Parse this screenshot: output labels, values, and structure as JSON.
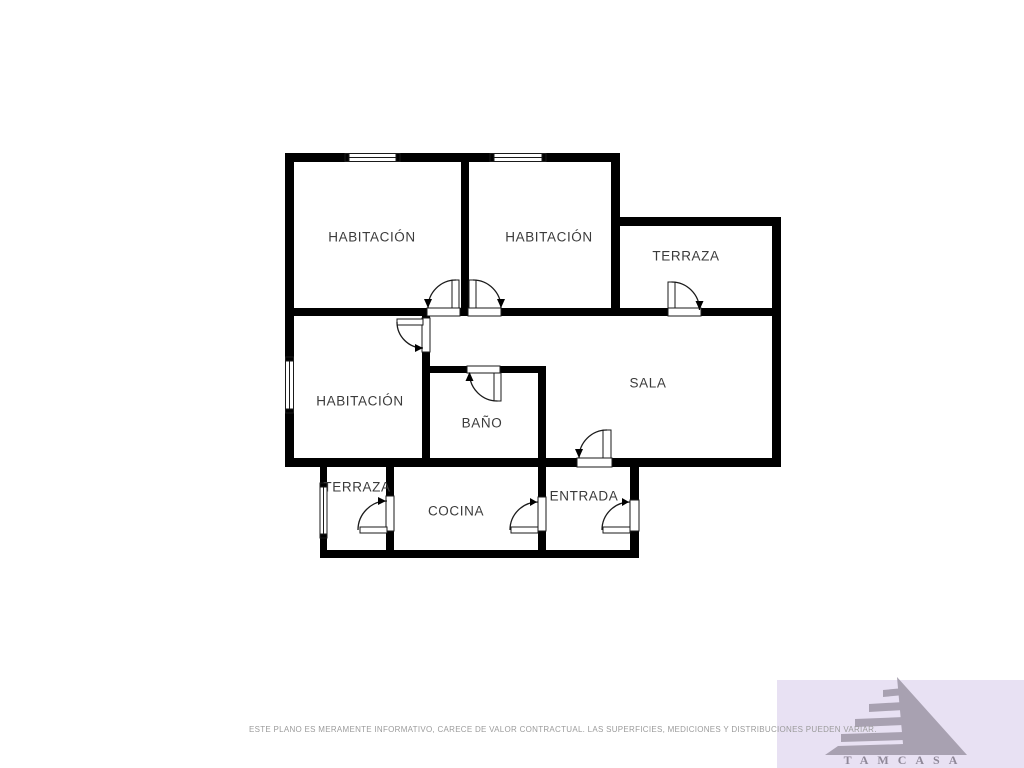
{
  "floorplan": {
    "rooms": {
      "bedroom_top_left": {
        "label": "HABITACIÓN"
      },
      "bedroom_top_right": {
        "label": "HABITACIÓN"
      },
      "terrace_upper": {
        "label": "TERRAZA"
      },
      "bedroom_left": {
        "label": "HABITACIÓN"
      },
      "bathroom": {
        "label": "BAÑO"
      },
      "living_room": {
        "label": "SALA"
      },
      "terrace_lower": {
        "label": "TERRAZA"
      },
      "kitchen": {
        "label": "COCINA"
      },
      "entrance": {
        "label": "ENTRADA"
      }
    },
    "symbols": {
      "door_count": 9,
      "window_count": 4
    },
    "colors": {
      "walls": "#000000",
      "room_label": "#3b3b3b",
      "background": "#ffffff"
    }
  },
  "footer": {
    "disclaimer": "ESTE PLANO ES MERAMENTE INFORMATIVO, CARECE DE VALOR CONTRACTUAL. LAS SUPERFICIES, MEDICIONES Y DISTRIBUCIONES PUEDEN VARIAR."
  },
  "logo": {
    "brand": "TAMCASA",
    "colors": {
      "background": "#e8e1f3",
      "pyramid": "#a8a1b1",
      "text": "#8f8898",
      "disclaimer_text": "#9b9b9b"
    }
  }
}
